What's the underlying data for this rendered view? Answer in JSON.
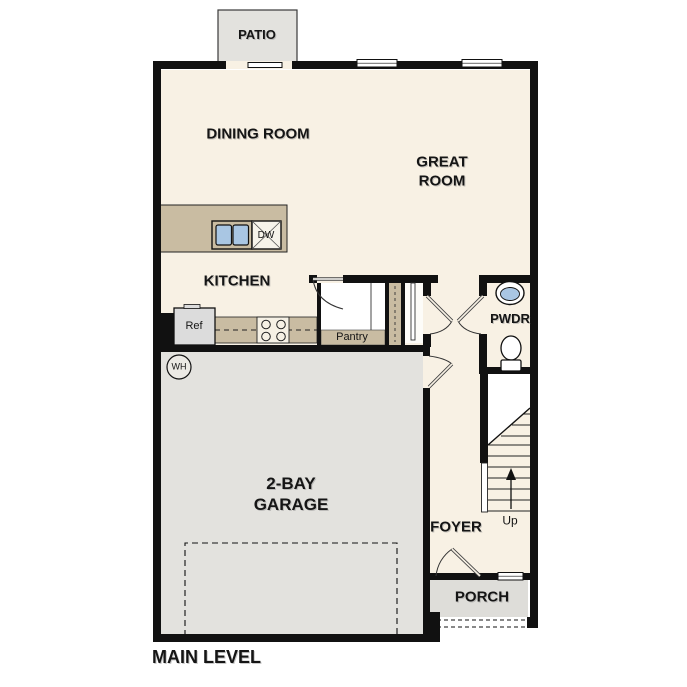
{
  "plan": {
    "level_label": "MAIN LEVEL",
    "rooms": {
      "patio": "PATIO",
      "dining": "DINING ROOM",
      "great": "GREAT ROOM",
      "kitchen": "KITCHEN",
      "pantry": "Pantry",
      "powder": "PWDR",
      "foyer": "FOYER",
      "garage": "2-BAY GARAGE",
      "porch": "PORCH"
    },
    "fixtures": {
      "refrigerator": "Ref",
      "dishwasher": "DW",
      "water_heater": "WH",
      "stair_direction": "Up"
    },
    "colors": {
      "wall": "#111111",
      "floor": "#f8f1e4",
      "casework": "#c9bca2",
      "concrete": "#e3e2de",
      "porch_concrete": "#deddd9",
      "sink_fill": "#a9c6e3",
      "appliance": "#dcdcdc"
    }
  }
}
